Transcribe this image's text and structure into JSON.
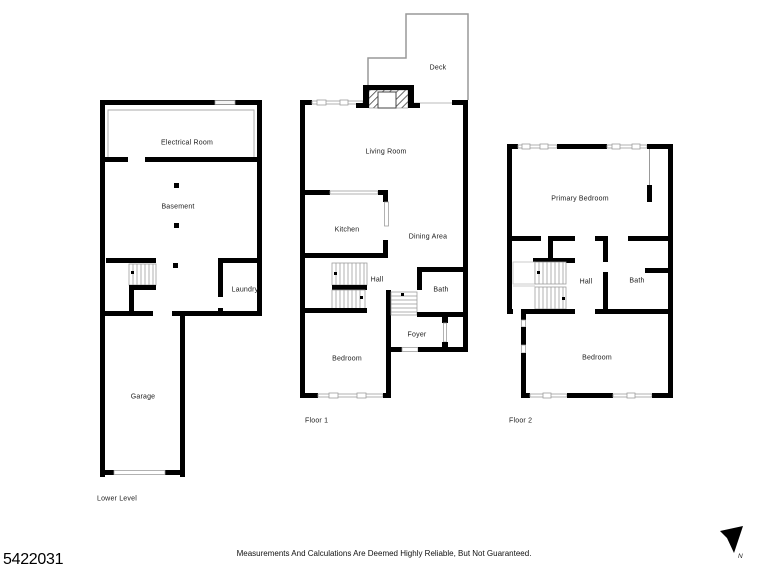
{
  "floors": {
    "lower_level": {
      "label": "Lower Level",
      "rooms": {
        "electrical_room": "Electrical Room",
        "basement": "Basement",
        "laundry": "Laundry",
        "garage": "Garage"
      }
    },
    "floor_1": {
      "label": "Floor 1",
      "rooms": {
        "deck": "Deck",
        "living_room": "Living Room",
        "kitchen": "Kitchen",
        "dining_area": "Dining Area",
        "hall": "Hall",
        "bath": "Bath",
        "foyer": "Foyer",
        "bedroom": "Bedroom"
      }
    },
    "floor_2": {
      "label": "Floor 2",
      "rooms": {
        "primary_bedroom": "Primary Bedroom",
        "hall": "Hall",
        "bath": "Bath",
        "bedroom": "Bedroom"
      }
    }
  },
  "footer": {
    "mls_number": "5422031",
    "disclaimer": "Measurements And Calculations Are Deemed Highly Reliable, But Not Guaranteed.",
    "compass_label": "N"
  },
  "colors": {
    "wall": "#000000",
    "thin_line": "#999999",
    "background": "#ffffff",
    "text": "#1a1a1a"
  }
}
